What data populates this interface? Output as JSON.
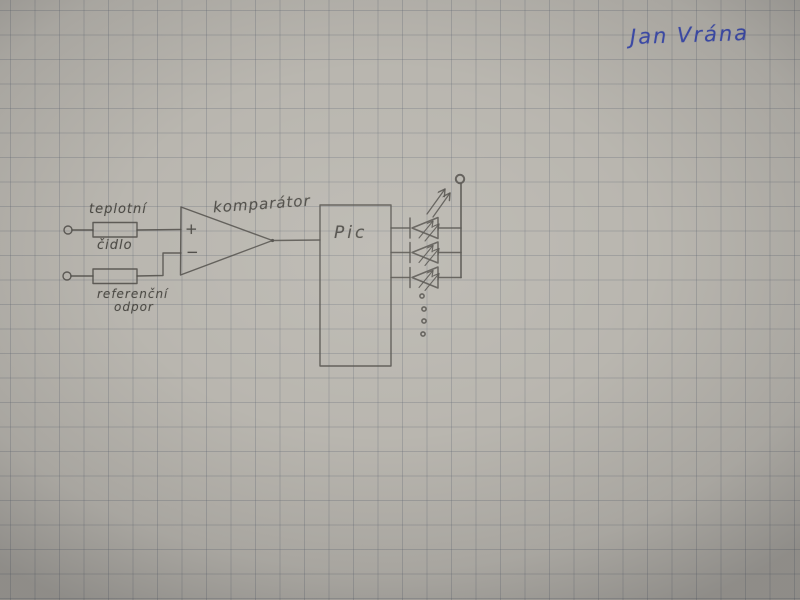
{
  "scene": {
    "description": "Photograph of a hand-drawn electronic schematic in pencil on squared (graph) paper",
    "paper_color": "#b9b6af",
    "grid_color": "#646a76",
    "pencil_color": "#514f4a",
    "ink_color": "#3e4dae"
  },
  "signature": {
    "text": "Jan Vrána"
  },
  "schematic": {
    "labels": {
      "sensor_line1": "teplotní",
      "sensor_line2": "čidlo",
      "reference_line1": "referenční",
      "reference_line2": "odpor",
      "comparator": "komparátor",
      "comparator_plus": "+",
      "comparator_minus": "−",
      "mcu": "Pic"
    },
    "components": [
      {
        "name": "input-terminal-top",
        "kind": "open terminal circle"
      },
      {
        "name": "temperature-sensor-resistor",
        "kind": "resistor box",
        "label": "teplotní čidlo"
      },
      {
        "name": "input-terminal-bottom",
        "kind": "open terminal circle"
      },
      {
        "name": "reference-resistor",
        "kind": "resistor box",
        "label": "referenční odpor"
      },
      {
        "name": "comparator",
        "kind": "op-amp triangle",
        "label": "komparátor",
        "inputs": [
          "+",
          "−"
        ]
      },
      {
        "name": "pic-microcontroller",
        "kind": "rectangle",
        "label": "Pic"
      },
      {
        "name": "led-1",
        "kind": "LED with emission arrows"
      },
      {
        "name": "led-2",
        "kind": "LED with emission arrows"
      },
      {
        "name": "led-3",
        "kind": "LED with emission arrows"
      },
      {
        "name": "supply-terminal",
        "kind": "terminal circle on vertical rail"
      },
      {
        "name": "continuation-dots",
        "kind": "four dots meaning more LEDs"
      }
    ]
  }
}
